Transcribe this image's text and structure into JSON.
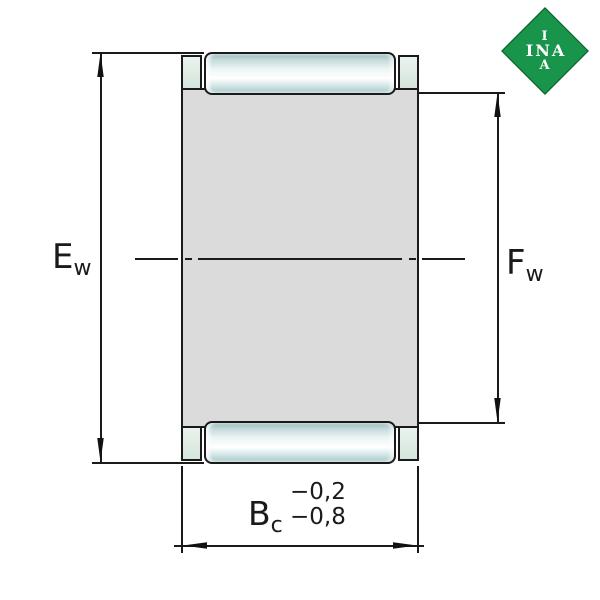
{
  "drawing": {
    "type": "bearing-cross-section",
    "labels": {
      "left": {
        "main": "E",
        "sub": "w"
      },
      "right": {
        "main": "F",
        "sub": "w"
      },
      "bottom": {
        "main": "B",
        "sub": "c",
        "tol_upper": "−0,2",
        "tol_lower": "−0,8"
      }
    },
    "colors": {
      "outline": "#1a1a1a",
      "cage_body_gray": "#dbdbdb",
      "roller_teal_edge": "#a5c5c7",
      "roller_highlight": "#ffffff",
      "cage_tab_green": "#dfece6"
    }
  },
  "logo": {
    "line1": "I",
    "line2": "INA",
    "line3": "A",
    "green": "#18954b"
  }
}
